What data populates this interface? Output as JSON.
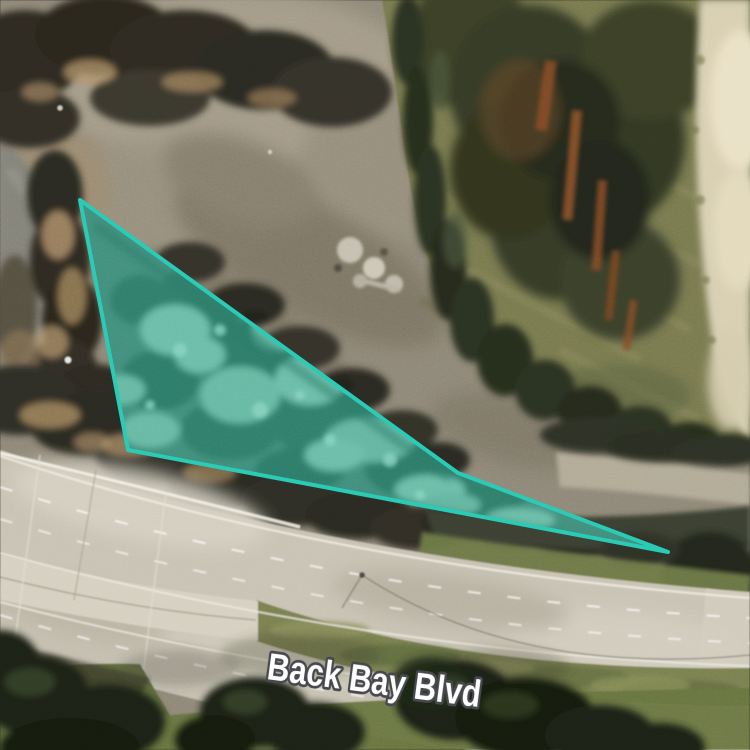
{
  "map": {
    "road_label": {
      "text": "Back Bay Blvd",
      "text_color": "#ffffff",
      "halo_color": "#45464b"
    },
    "annotation": {
      "points": "80,200 458,473 668,552 128,450",
      "stroke_color": "#28cab4",
      "stroke_width": "4",
      "fill_color": "#2bd0b8",
      "fill_opacity": "0.36"
    }
  }
}
